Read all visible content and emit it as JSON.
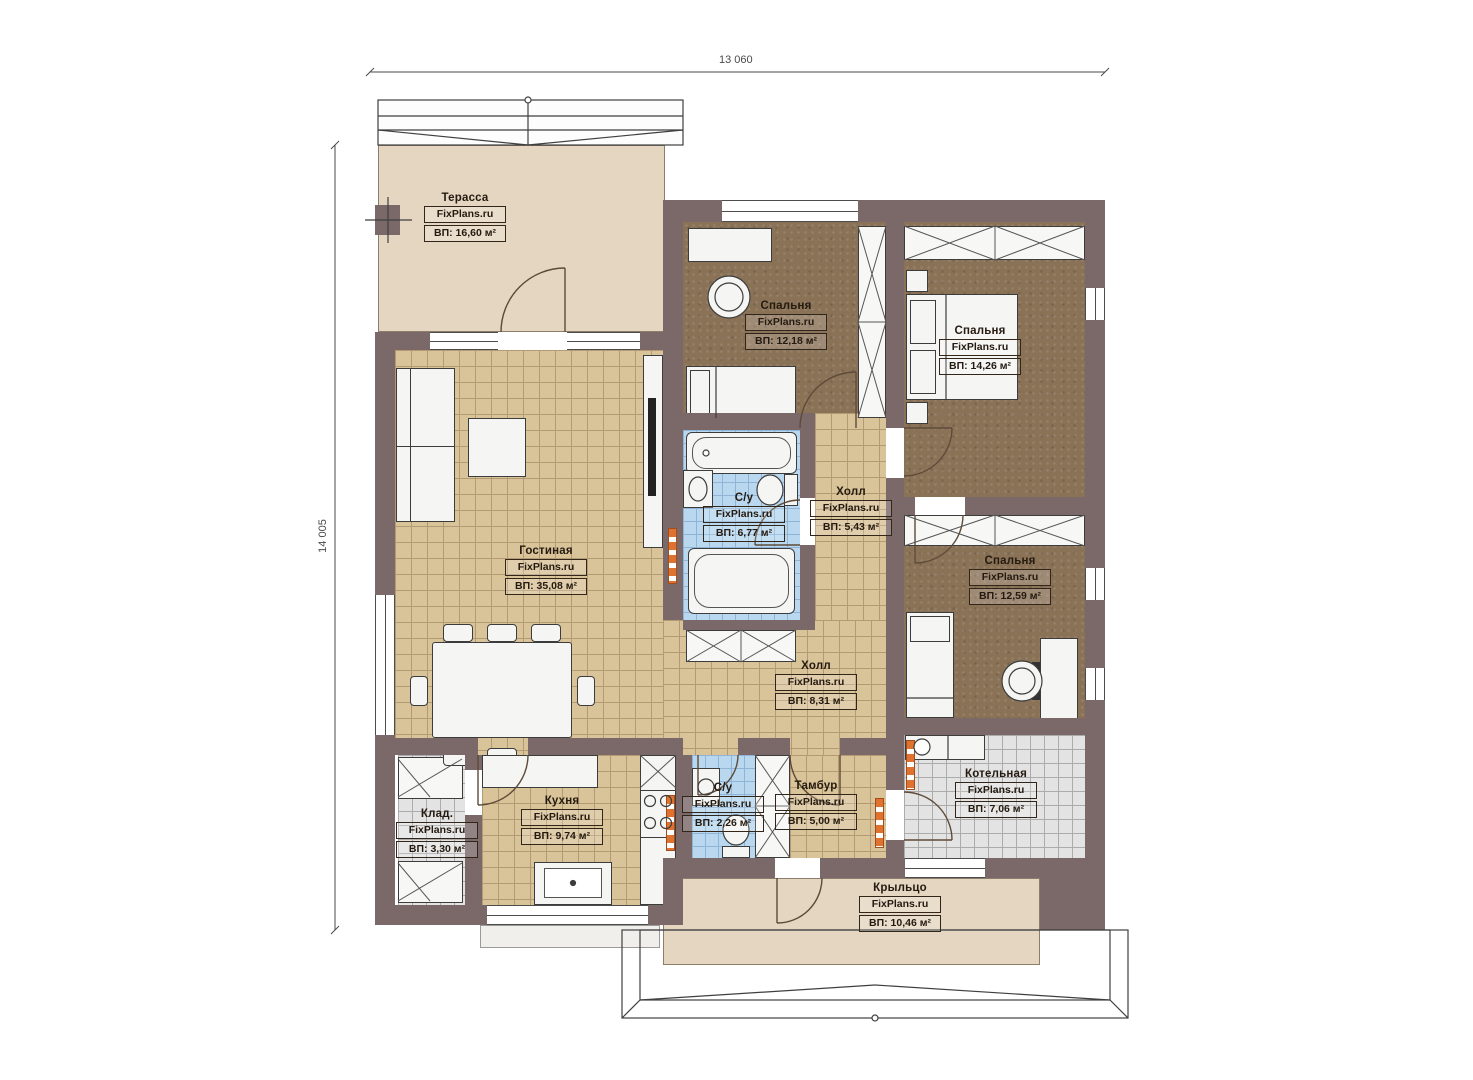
{
  "title": "План одноэтажного дома",
  "watermark": "FixPlans.ru",
  "dimensions": {
    "width_label": "13 060",
    "height_label": "14 005"
  },
  "rooms": {
    "terrace": {
      "name": "Терасса",
      "area": "ВП: 16,60 м²"
    },
    "bedroom1": {
      "name": "Спальня",
      "area": "ВП: 12,18 м²"
    },
    "bedroom2": {
      "name": "Спальня",
      "area": "ВП: 14,26 м²"
    },
    "bathroom1": {
      "name": "С/у",
      "area": "ВП: 6,77 м²"
    },
    "hall1": {
      "name": "Холл",
      "area": "ВП: 5,43 м²"
    },
    "living": {
      "name": "Гостиная",
      "area": "ВП: 35,08 м²"
    },
    "bedroom3": {
      "name": "Спальня",
      "area": "ВП: 12,59 м²"
    },
    "hall2": {
      "name": "Холл",
      "area": "ВП: 8,31 м²"
    },
    "storage": {
      "name": "Клад.",
      "area": "ВП: 3,30 м²"
    },
    "kitchen": {
      "name": "Кухня",
      "area": "ВП: 9,74 м²"
    },
    "bathroom2": {
      "name": "С/у",
      "area": "ВП: 2,26 м²"
    },
    "vestibule": {
      "name": "Тамбур",
      "area": "ВП: 5,00 м²"
    },
    "boiler": {
      "name": "Котельная",
      "area": "ВП: 7,06 м²"
    },
    "porch": {
      "name": "Крыльцо",
      "area": "ВП: 10,46 м²"
    }
  },
  "colors": {
    "wall": "#7b6869",
    "tile_beige": "#d9c399",
    "tile_beige_line": "#b49a72",
    "tile_blue": "#b9d8f0",
    "tile_blue_line": "#8fb4d6",
    "tile_gray": "#e3e3e3",
    "tile_gray_line": "#ababab",
    "carpet": "#8a7257",
    "deck": "#e4d6c1",
    "radiator": "#e0722f",
    "ink": "#241a10",
    "fixture": "#f5f5f3"
  }
}
